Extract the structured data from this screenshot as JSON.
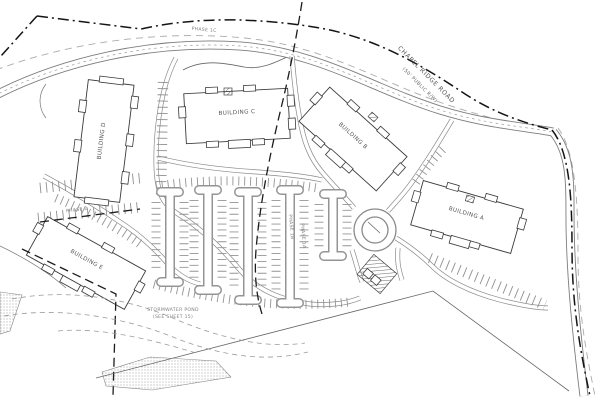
{
  "site_plan": {
    "road": {
      "name": "CHAPEL RIDGE ROAD",
      "right_of_way": "(50' PUBLIC R/W)"
    },
    "buildings": {
      "a": "BUILDING A",
      "b": "BUILDING B",
      "c": "BUILDING C",
      "d": "BUILDING D",
      "e": "BUILDING E"
    },
    "stormwater_pond": {
      "line1": "STORMWATER POND",
      "line2": "(SEE SHEET 15)"
    },
    "phases": {
      "phase_1a": "PHASE 1A",
      "phase_1b": "PHASE 1B",
      "phase_1c": "PHASE 1C",
      "phase_2": "PHASE 2"
    },
    "colors": {
      "paper": "#ffffff",
      "linework": "#3a3a3a",
      "road_gray": "#8a8a8a",
      "boundary_black": "#141414"
    }
  }
}
